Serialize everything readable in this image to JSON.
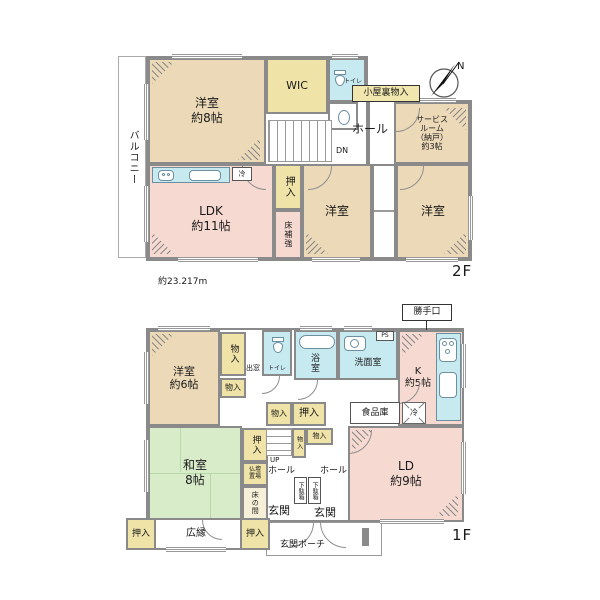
{
  "meta": {
    "floor2_label": "2F",
    "floor1_label": "1F",
    "dimension": "約23.217m",
    "compass_n": "N"
  },
  "colors": {
    "western": "#ecd9b8",
    "pink": "#f6d9d1",
    "green": "#d9ecca",
    "closet": "#efe3a8",
    "wet": "#c7eaf1",
    "wall": "#8a8a8a",
    "tag": "#f0e6ae"
  },
  "f2": {
    "balcony": "バルコニー",
    "western8": "洋室\n約8帖",
    "wic": "WIC",
    "toilet": "トイレ",
    "attic": "小屋裏物入",
    "hall": "ホール",
    "dn": "DN",
    "service": "サービス\nルーム\n（納戸）\n約3帖",
    "ldk": "LDK\n約11帖",
    "fridge": "冷",
    "oshiire": "押入",
    "floor_reinforce": "床補強",
    "western_center": "洋室",
    "western_right": "洋室"
  },
  "f1": {
    "western6": "洋室\n約6帖",
    "monoire_a": "物入",
    "monoire_b": "物入",
    "baywindow": "出窓",
    "toilet": "トイレ",
    "bath": "浴室",
    "washroom": "洗面室",
    "ps": "PS",
    "backdoor": "勝手口",
    "kitchen": "K\n約5帖",
    "pantry": "食品庫",
    "fridge": "冷",
    "monoire_c": "物入",
    "oshiire_a": "押入",
    "washitsu": "和室\n8帖",
    "oshiire_b": "押入",
    "butsudan": "仏壇\n置場",
    "tokonoma": "床の間",
    "up": "UP",
    "monoire_d": "物入",
    "monoire_e": "物入",
    "hall_a": "ホール",
    "hall_b": "ホール",
    "getabako_a": "下駄箱",
    "getabako_b": "下駄箱",
    "genkan_a": "玄関",
    "genkan_b": "玄関",
    "oshiire_c": "押入",
    "engawa": "広縁",
    "oshiire_d": "押入",
    "porch": "玄関ポーチ",
    "ld": "LD\n約9帖"
  }
}
